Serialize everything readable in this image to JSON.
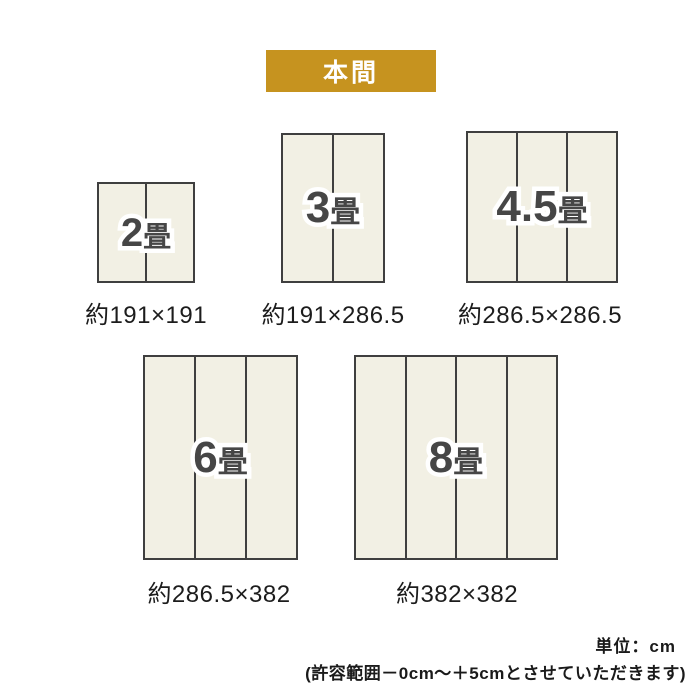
{
  "badge": {
    "label": "本間",
    "bg_color": "#c6931f",
    "text_color": "#ffffff"
  },
  "sizes": [
    {
      "name": "2畳",
      "label_num": "2",
      "label_unit": "畳",
      "dimensions": "約191×191",
      "panels": 2
    },
    {
      "name": "3畳",
      "label_num": "3",
      "label_unit": "畳",
      "dimensions": "約191×286.5",
      "panels": 2
    },
    {
      "name": "4.5畳",
      "label_num": "4.5",
      "label_unit": "畳",
      "dimensions": "約286.5×286.5",
      "panels": 3
    },
    {
      "name": "6畳",
      "label_num": "6",
      "label_unit": "畳",
      "dimensions": "約286.5×382",
      "panels": 3
    },
    {
      "name": "8畳",
      "label_num": "8",
      "label_unit": "畳",
      "dimensions": "約382×382",
      "panels": 4
    }
  ],
  "footer": {
    "unit_label": "単位：cm",
    "tolerance_note": "(許容範囲－0cm～＋5cmとさせていただきます)"
  },
  "colors": {
    "mat_fill": "#f2f0e4",
    "mat_border": "#3f3f3f",
    "size_label_text": "#464646",
    "size_label_outline": "#ffffff",
    "dimension_text": "#1c1c1c",
    "badge_bg": "#c6931f"
  }
}
